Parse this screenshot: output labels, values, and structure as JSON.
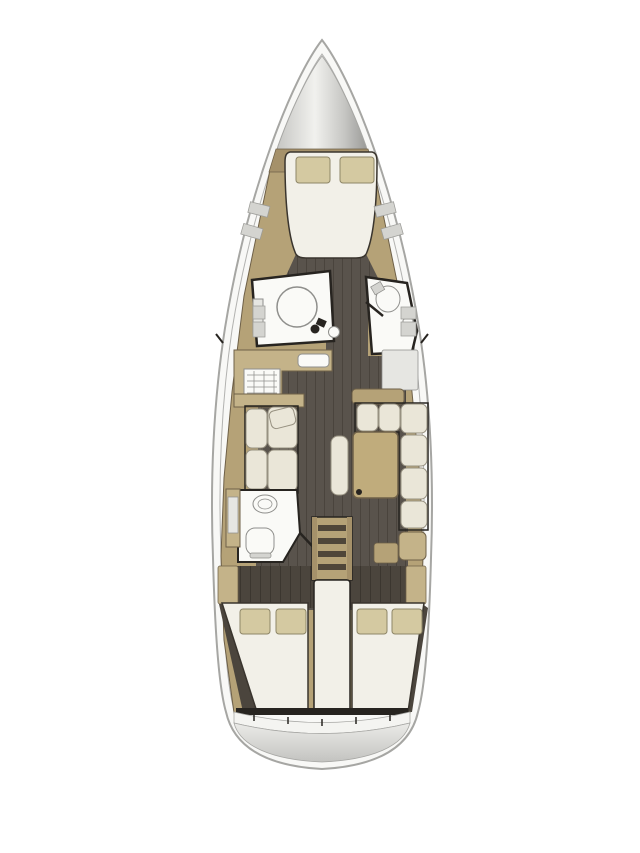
{
  "diagram": {
    "type": "sailing-yacht-interior-floor-plan",
    "orientation": "bow-up",
    "areas": [
      "anchor-locker",
      "forward-double-cabin",
      "port-shower-room",
      "starboard-head",
      "galley",
      "saloon-l-sofa-table",
      "port-aft-head",
      "companionway-steps",
      "port-aft-double-cabin",
      "starboard-aft-double-cabin",
      "stern-swim-platform"
    ]
  },
  "colors": {
    "paper": "#ffffff",
    "hull": "#f8f8f6",
    "hullLine": "#a6a6a3",
    "bowLight": "#f1f1ee",
    "bowMid": "#c6c6c3",
    "bowDark": "#9b9b98",
    "wood": "#b5a277",
    "woodLight": "#c4b389",
    "woodDark": "#a5916a",
    "woodEdge": "#6e6048",
    "floor": "#59534c",
    "floorLine": "#423d36",
    "wardrobe": "#4b453d",
    "wardrobeLine": "#36322b",
    "wall": "#272420",
    "bed": "#f2f0e8",
    "bedEdge": "#3a352e",
    "pillow": "#d4c9a1",
    "pillowEdge": "#8e8667",
    "cushion": "#eae6d8",
    "cushionEdge": "#979181",
    "bath": "#fafaf7",
    "fixture": "#8f8f8c",
    "grayBox": "#d4d4d0",
    "grayBoxEdge": "#9c9c98",
    "lightPanel": "#e6e6e2",
    "step": "#4f4639",
    "table": "#c0ac7c",
    "tableEdge": "#6e6048",
    "band": "#f4f4f1",
    "platformTop": "#ebebe8",
    "platformBottom": "#c3c3c0"
  }
}
